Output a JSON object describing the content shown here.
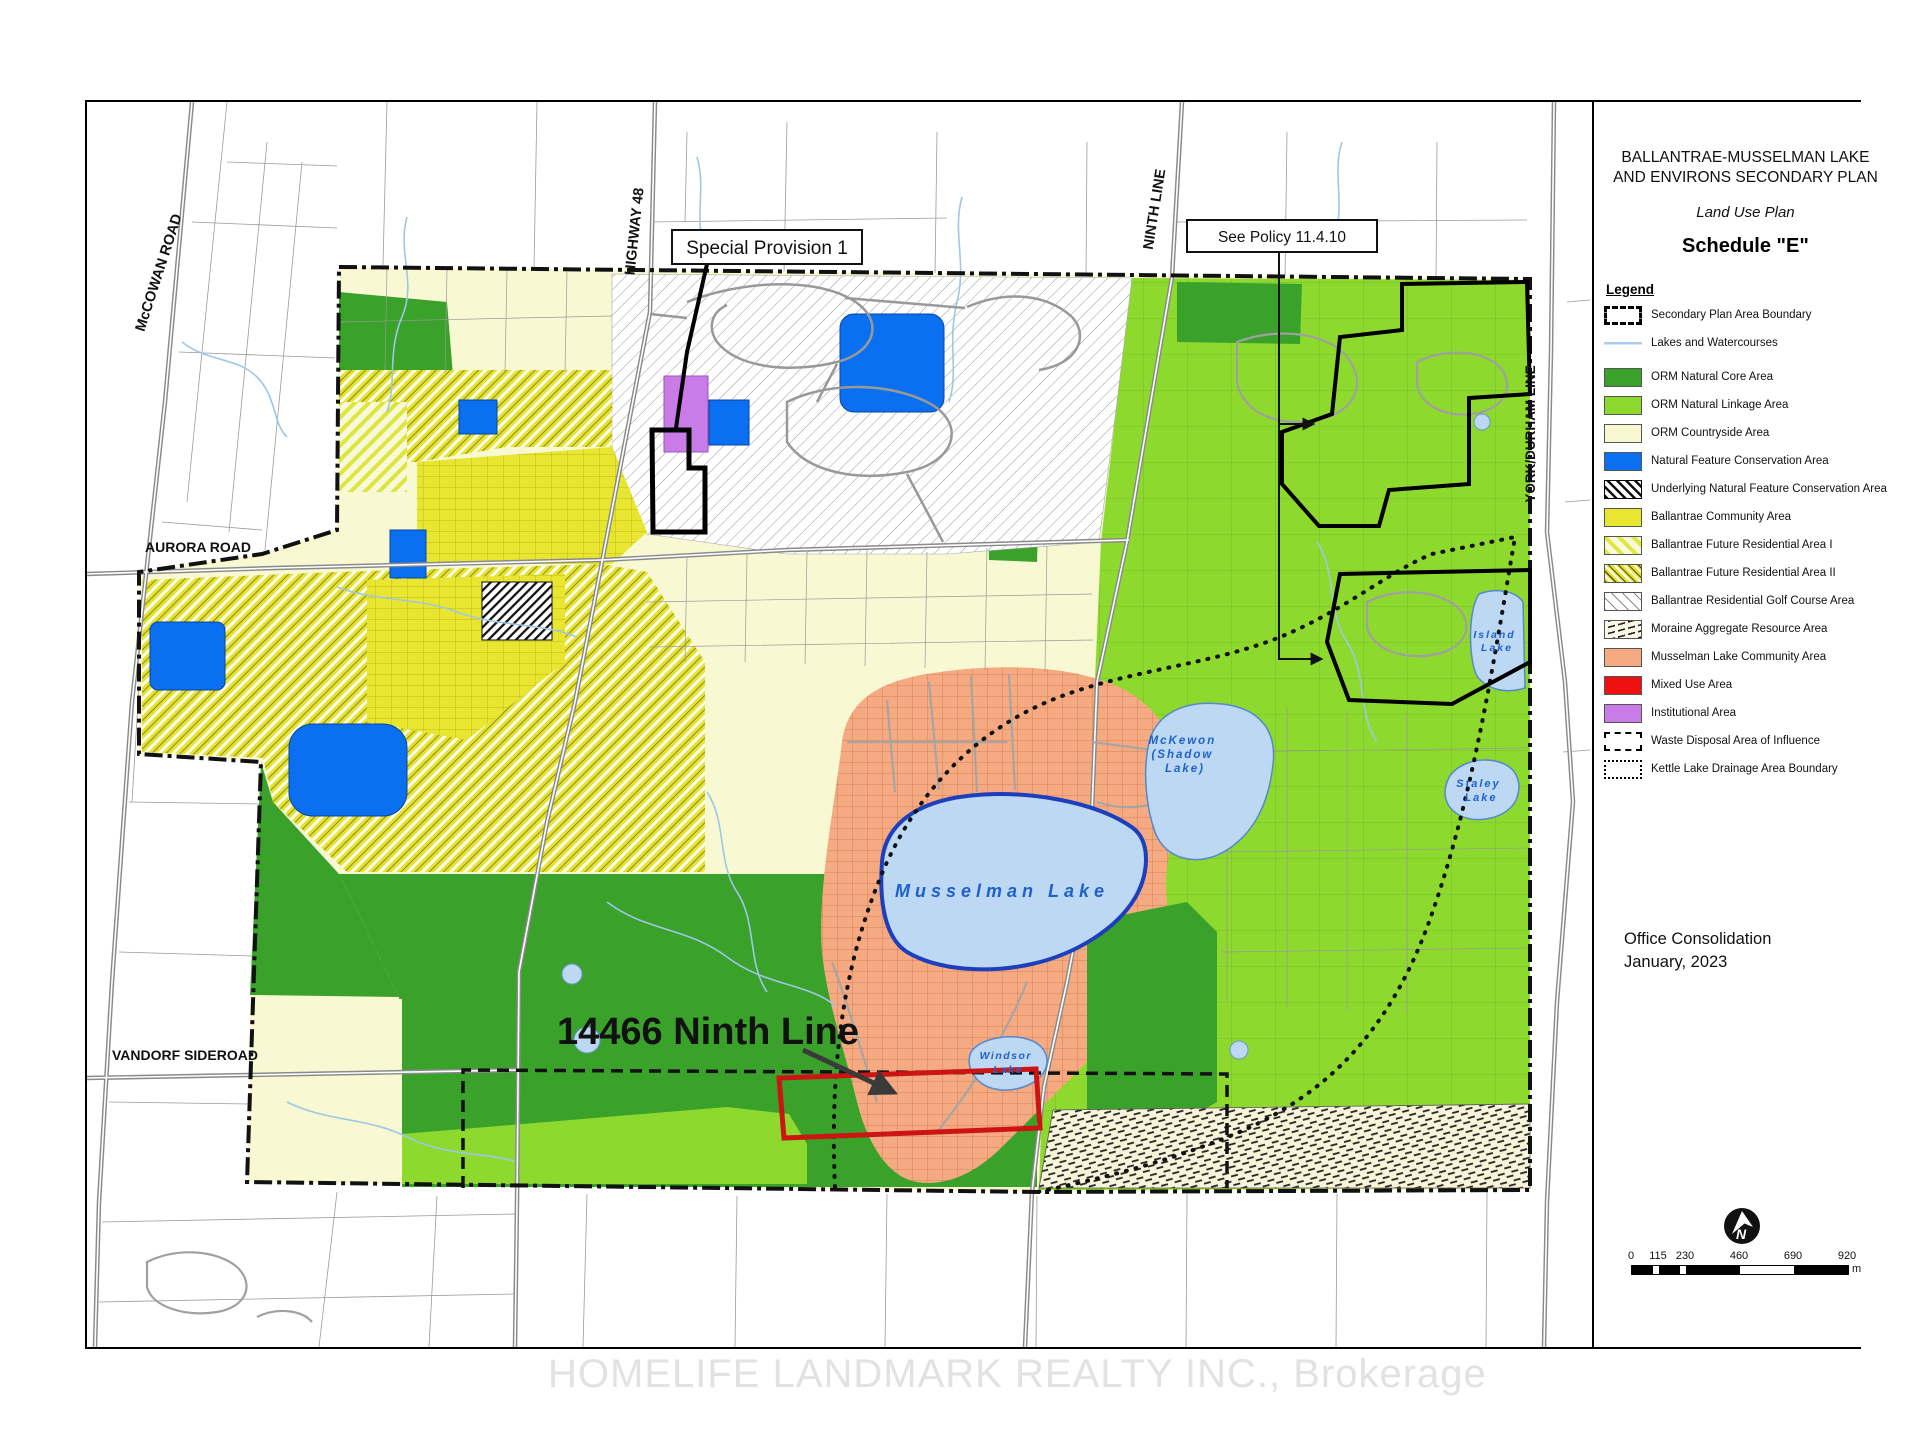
{
  "header": {
    "title_line1": "BALLANTRAE-MUSSELMAN LAKE",
    "title_line2": "AND ENVIRONS SECONDARY PLAN",
    "subtitle": "Land Use Plan",
    "schedule": "Schedule \"E\""
  },
  "legend": {
    "heading": "Legend",
    "items": [
      {
        "label": "Secondary Plan Area Boundary"
      },
      {
        "label": "Lakes and Watercourses"
      },
      {
        "label": "ORM Natural Core Area"
      },
      {
        "label": "ORM Natural Linkage Area"
      },
      {
        "label": "ORM Countryside Area"
      },
      {
        "label": "Natural Feature Conservation Area"
      },
      {
        "label": "Underlying Natural Feature Conservation Area"
      },
      {
        "label": "Ballantrae Community Area"
      },
      {
        "label": "Ballantrae Future Residential Area I"
      },
      {
        "label": "Ballantrae Future Residential Area II"
      },
      {
        "label": "Ballantrae Residential Golf Course Area"
      },
      {
        "label": "Moraine Aggregate Resource Area"
      },
      {
        "label": "Musselman Lake Community Area"
      },
      {
        "label": "Mixed Use Area"
      },
      {
        "label": "Institutional Area"
      },
      {
        "label": "Waste Disposal Area of Influence"
      },
      {
        "label": "Kettle Lake Drainage Area Boundary"
      }
    ]
  },
  "notes": {
    "office_line1": "Office Consolidation",
    "office_line2": "January, 2023"
  },
  "scalebar": {
    "ticks": [
      "0",
      "115",
      "230",
      "460",
      "690",
      "920"
    ],
    "unit": "m"
  },
  "north_label": "N",
  "map": {
    "annotations": {
      "special_provision": "Special Provision 1",
      "see_policy": "See Policy 11.4.10",
      "property_label": "14466 Ninth Line"
    },
    "roads": {
      "mccowan": "McCOWAN ROAD",
      "highway48": "HIGHWAY 48",
      "ninth": "NINTH LINE",
      "york_durham": "YORK/DURHAM LINE",
      "aurora": "AURORA ROAD",
      "vandorf": "VANDORF SIDEROAD"
    },
    "lakes": {
      "musselman": "Musselman Lake",
      "mckewon_l1": "McKewon",
      "mckewon_l2": "(Shadow",
      "mckewon_l3": "Lake)",
      "island_l1": "Island",
      "island_l2": "Lake",
      "staley_l1": "Staley",
      "staley_l2": "Lake",
      "windsor_l1": "Windsor",
      "windsor_l2": "Lake"
    }
  },
  "watermark": "HOMELIFE LANDMARK REALTY INC., Brokerage",
  "colors": {
    "orm_core": "#3aa12b",
    "orm_linkage": "#8ed92e",
    "countryside": "#f8f8d0",
    "conservation_blue": "#0a6ff0",
    "ballantrae_yellow": "#e8e630",
    "musselman_salmon": "#f5aa82",
    "mixed_use_red": "#ee1111",
    "institutional_purple": "#c97ce8",
    "lake_blue": "#bcd8f2",
    "highlight_red": "#cc1512"
  }
}
